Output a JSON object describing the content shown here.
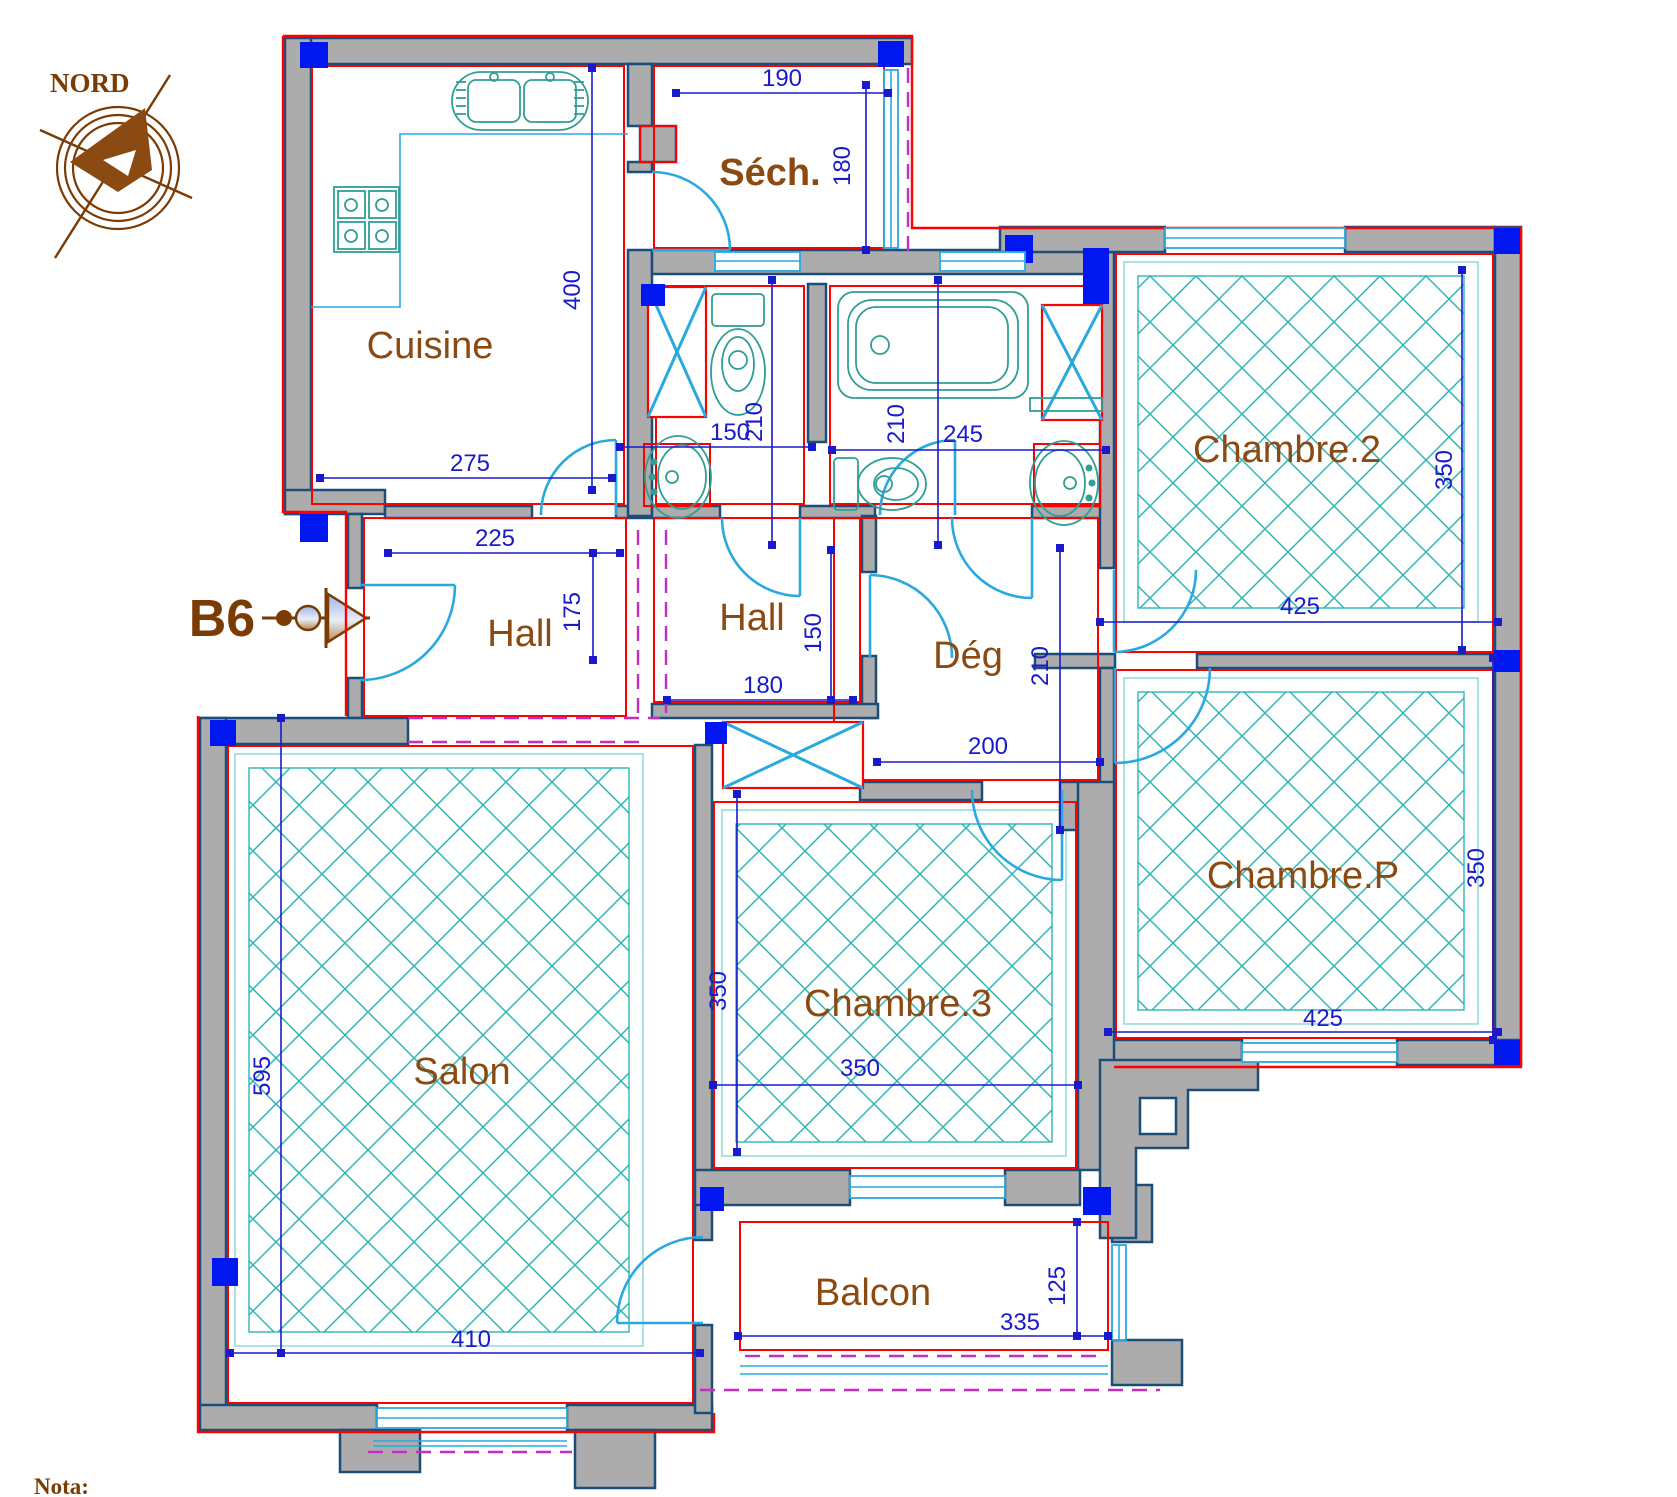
{
  "compass": {
    "label": "NORD"
  },
  "entrance": {
    "label": "B6"
  },
  "note": {
    "label": "Nota:"
  },
  "rooms": {
    "cuisine": "Cuisine",
    "sech": "Séch.",
    "chambre2": "Chambre.2",
    "hall1": "Hall",
    "hall2": "Hall",
    "deg": "Dég",
    "salon": "Salon",
    "chambre3": "Chambre.3",
    "chambrep": "Chambre.P",
    "balcon": "Balcon"
  },
  "dims": {
    "sech_w": "190",
    "sech_h": "180",
    "cuisine_h": "400",
    "cuisine_w": "275",
    "hall1_w": "225",
    "hall1_h": "175",
    "wc_w": "150",
    "wc_h": "210",
    "bain_h": "210",
    "bain_w": "245",
    "ch2_w": "425",
    "ch2_h": "350",
    "hall2_w": "180",
    "hall2_h": "150",
    "deg_h": "210",
    "deg_w": "200",
    "salon_h": "595",
    "salon_w": "410",
    "ch3_h": "350",
    "ch3_w": "350",
    "chp_w": "425",
    "chp_h": "350",
    "balcon_w": "335",
    "balcon_h": "125"
  },
  "colors": {
    "wall_gray": "#ACACAC",
    "wall_outline_navy": "#1C4E78",
    "accent_red": "#FF0000",
    "column_blue": "#0018EF",
    "fixture_blue": "#2AA8E0",
    "fixture_teal": "#2E9E96",
    "hatch_teal": "#2FB5B5",
    "dim_blue": "#1A1ACD",
    "label_brown": "#8A4A12",
    "dark_brown": "#7A3B05",
    "dashed_magenta": "#C32FC3"
  }
}
